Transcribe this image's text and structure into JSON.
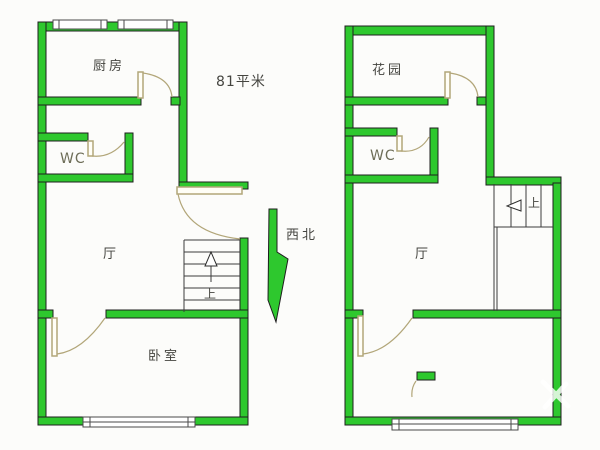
{
  "area_label": "81平米",
  "compass_label": "西北",
  "unit_left": {
    "kitchen": "厨房",
    "wc": "WC",
    "hall": "厅",
    "bedroom": "卧室",
    "stairs_up_label": "上"
  },
  "unit_right": {
    "garden": "花园",
    "wc": "WC",
    "hall": "厅",
    "stairs_up_label": "上"
  },
  "colors": {
    "wall_green": "#2ec82e",
    "door_tan": "#b2a679",
    "text_ink": "#454540"
  }
}
